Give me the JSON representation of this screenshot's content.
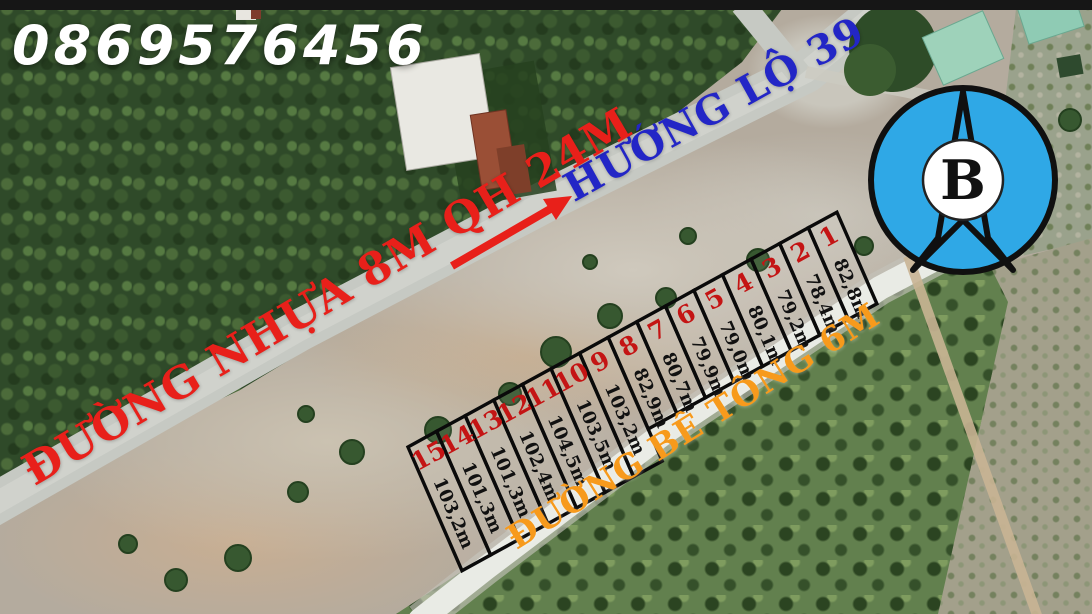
{
  "watermark": {
    "phone": "0869576456"
  },
  "road_labels": {
    "direction": "HƯỚNG LỘ 39",
    "asphalt": "ĐƯỜNG NHỰA 8M QH 24M",
    "concrete": "ĐƯỜNG BÊ TÔNG 6M"
  },
  "compass": {
    "label": "B"
  },
  "plots": [
    {
      "no": "1",
      "area": "82,8m"
    },
    {
      "no": "2",
      "area": "78,4m"
    },
    {
      "no": "3",
      "area": "79,2m"
    },
    {
      "no": "4",
      "area": "80,1m"
    },
    {
      "no": "5",
      "area": "79,0m"
    },
    {
      "no": "6",
      "area": "79,9m"
    },
    {
      "no": "7",
      "area": "80,7m"
    },
    {
      "no": "8",
      "area": "82,9m"
    },
    {
      "no": "9",
      "area": "103,2m"
    },
    {
      "no": "10",
      "area": "103,5m"
    },
    {
      "no": "11",
      "area": "104,5m"
    },
    {
      "no": "12",
      "area": "102,4m"
    },
    {
      "no": "13",
      "area": "101,3m"
    },
    {
      "no": "14",
      "area": "101,3m"
    },
    {
      "no": "15",
      "area": "103,2m"
    }
  ],
  "colors": {
    "phone_text": "#ffffff",
    "direction_label": "#2326c6",
    "asphalt_label": "#e8201a",
    "concrete_label": "#f79a1c",
    "plot_number": "#c41414",
    "plot_area_text": "#111111",
    "plot_border": "#0a0a0a",
    "compass_fill": "#2fa8e6"
  }
}
